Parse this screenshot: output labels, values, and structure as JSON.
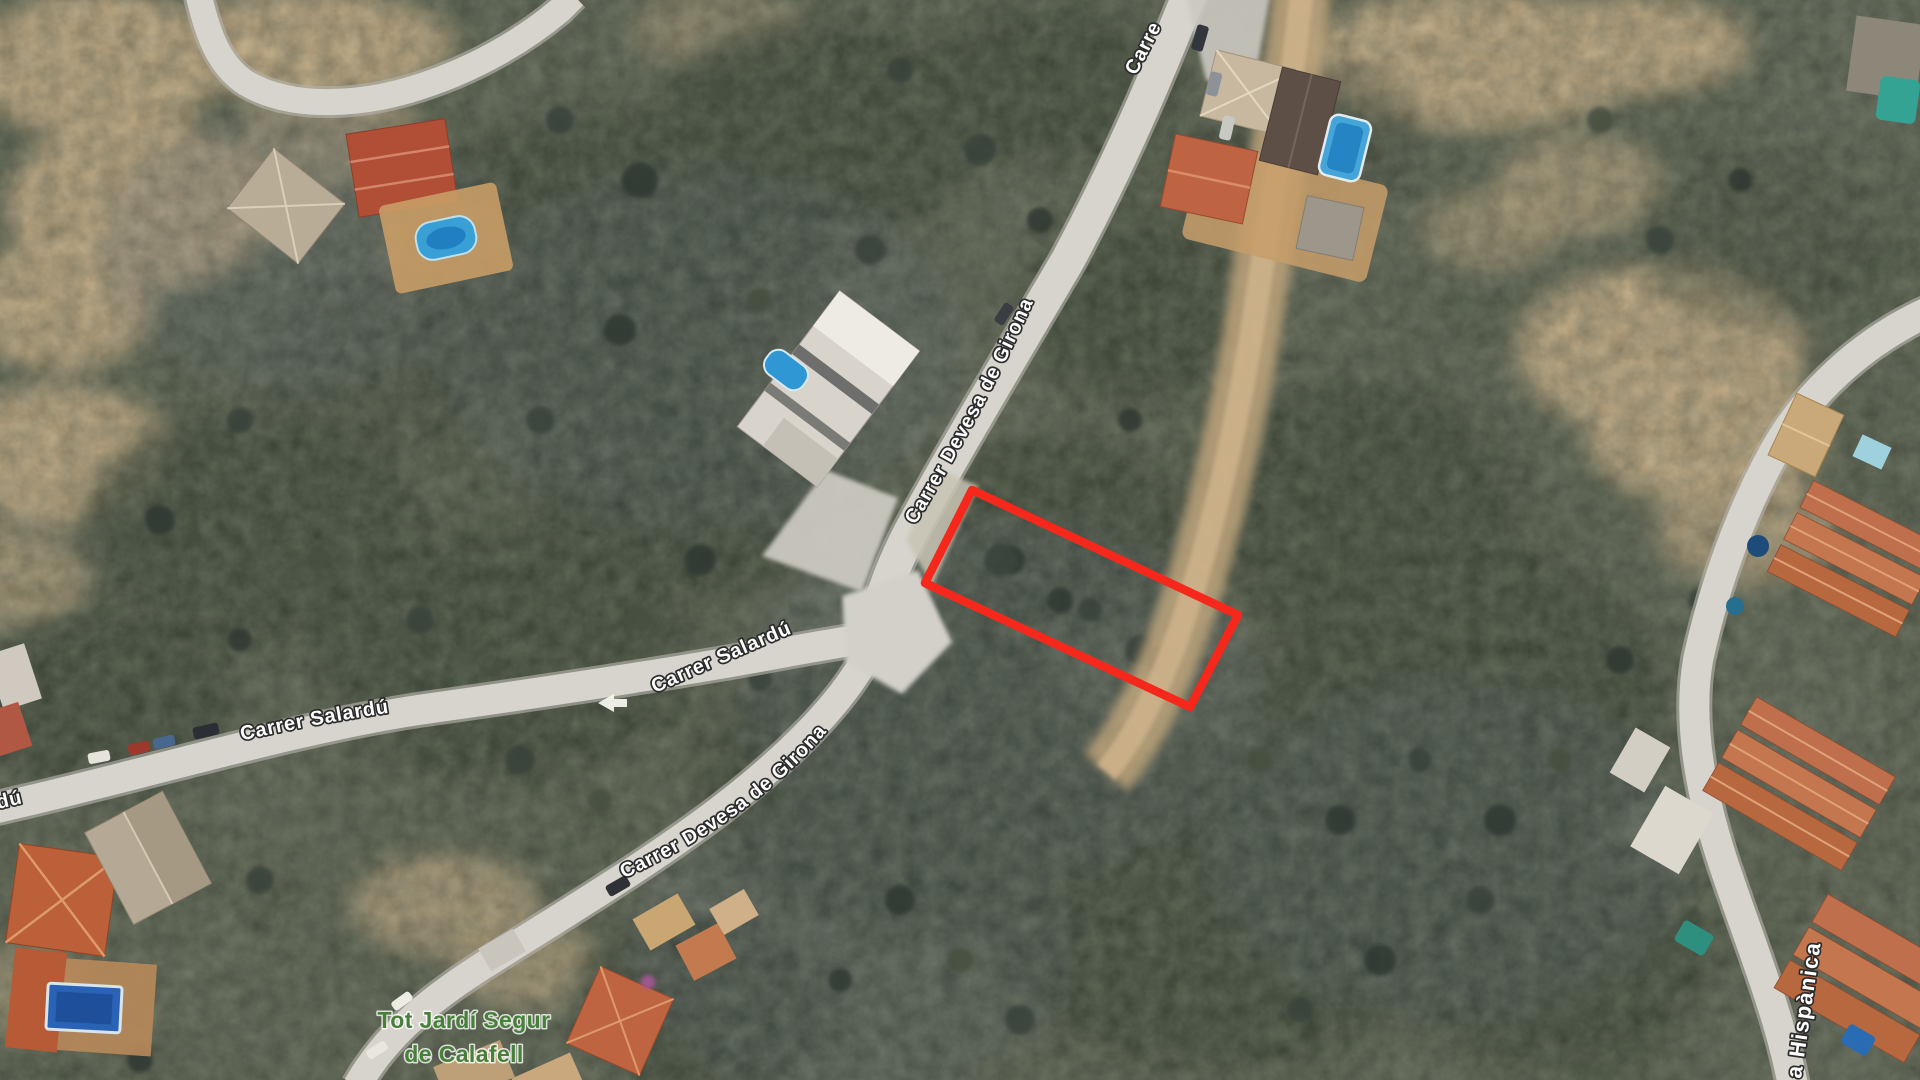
{
  "map": {
    "view": "satellite-aerial",
    "road_labels": {
      "devesa_upper": "Carrer Devesa de Girona",
      "devesa_lower": "Carrer Devesa de Girona",
      "devesa_top_partial": "Carre",
      "salardu_right": "Carrer Salardú",
      "salardu_left": "Carrer Salardú",
      "salardu_edge_partial": "dú",
      "hispanica_partial": "a Hispànica"
    },
    "place_labels": {
      "business_line1": "Tot Jardí Segur",
      "business_line2": "de Calafell"
    },
    "parcel": {
      "points": "972,490 1238,615 1190,707 925,583",
      "stroke_color": "#f5281b",
      "stroke_width": "8.5"
    },
    "colors": {
      "road_label_fill": "#ffffff",
      "road_label_outline": "#2b2b2b",
      "business_label": "#47803a",
      "road_surface": "#d6d4cd",
      "terrain_scrub": "#6b7162",
      "terrain_sand": "#cdb289",
      "pool_blue": "#2f97d4"
    }
  }
}
